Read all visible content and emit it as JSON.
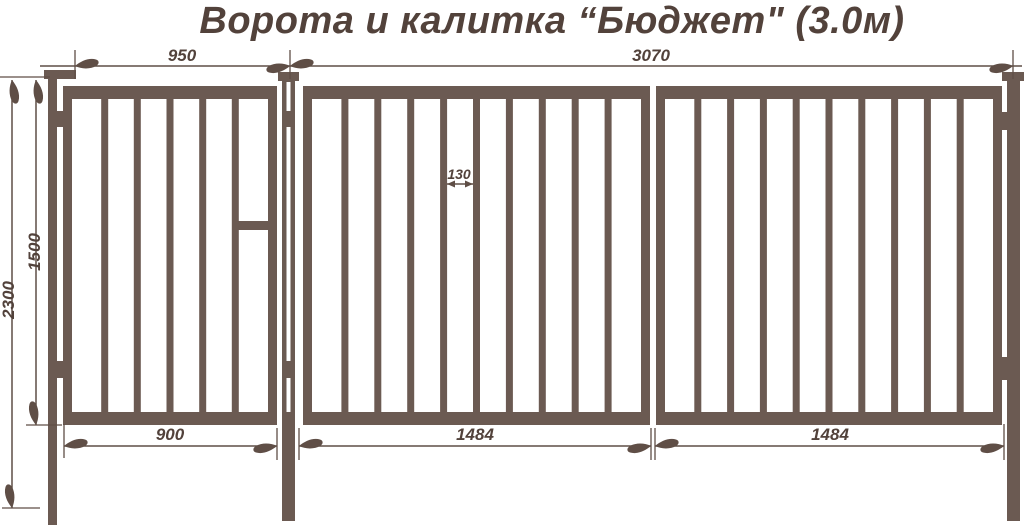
{
  "title": "Ворота и калитка “Бюджет\" (3.0м)",
  "colors": {
    "structure": "#6b5a52",
    "dim_line": "#5f4e46",
    "text": "#52423b",
    "background": "#ffffff"
  },
  "product": {
    "wicket": {
      "name_ru": "калитка",
      "opening_width_mm": 950,
      "frame_width_mm": 900,
      "frame_height_mm": 1500,
      "post_height_mm": 2300,
      "bars_count": 5
    },
    "gate": {
      "name_ru": "ворота",
      "opening_width_mm": 3070,
      "leaf_widths_mm": [
        1484,
        1484
      ],
      "bar_gap_mm": 130,
      "bars_per_leaf": 9
    }
  },
  "dimensions": {
    "d950": "950",
    "d3070": "3070",
    "d2300": "2300",
    "d1500": "1500",
    "d130": "130",
    "d900": "900",
    "d1484a": "1484",
    "d1484b": "1484"
  },
  "geometry": {
    "canvas": {
      "w": 1024,
      "h": 531
    },
    "bar": {
      "w": 7,
      "y": 99,
      "h": 313
    },
    "solids": [
      {
        "name": "left-post",
        "x": 48,
        "y": 78,
        "w": 9,
        "h": 447
      },
      {
        "name": "left-post-cap",
        "x": 44,
        "y": 70,
        "w": 32,
        "h": 9
      },
      {
        "name": "middle-post",
        "x": 282,
        "y": 80,
        "w": 13,
        "h": 441
      },
      {
        "name": "middle-post-cap",
        "x": 278,
        "y": 72,
        "w": 21,
        "h": 9
      },
      {
        "name": "right-post",
        "x": 1007,
        "y": 80,
        "w": 13,
        "h": 441
      },
      {
        "name": "right-post-cap",
        "x": 1002,
        "y": 72,
        "w": 22,
        "h": 9
      },
      {
        "name": "wicket-left-stile",
        "x": 63,
        "y": 86,
        "w": 9,
        "h": 339
      },
      {
        "name": "wicket-right-stile",
        "x": 268,
        "y": 86,
        "w": 9,
        "h": 339
      },
      {
        "name": "wicket-top-rail",
        "x": 63,
        "y": 86,
        "w": 214,
        "h": 13
      },
      {
        "name": "wicket-bottom-rail",
        "x": 63,
        "y": 412,
        "w": 214,
        "h": 13
      },
      {
        "name": "wicket-lock-crossbar",
        "x": 238,
        "y": 221,
        "w": 30,
        "h": 9
      },
      {
        "name": "gate-leaf1-left-stile",
        "x": 303,
        "y": 86,
        "w": 9,
        "h": 339
      },
      {
        "name": "gate-leaf1-right-stile",
        "x": 641,
        "y": 86,
        "w": 9,
        "h": 339
      },
      {
        "name": "gate-leaf1-top-rail",
        "x": 303,
        "y": 86,
        "w": 347,
        "h": 13
      },
      {
        "name": "gate-leaf1-bottom-rail",
        "x": 303,
        "y": 412,
        "w": 347,
        "h": 13
      },
      {
        "name": "gate-leaf2-left-stile",
        "x": 656,
        "y": 86,
        "w": 9,
        "h": 339
      },
      {
        "name": "gate-leaf2-right-stile",
        "x": 993,
        "y": 86,
        "w": 9,
        "h": 339
      },
      {
        "name": "gate-leaf2-top-rail",
        "x": 656,
        "y": 86,
        "w": 346,
        "h": 13
      },
      {
        "name": "gate-leaf2-bottom-rail",
        "x": 656,
        "y": 412,
        "w": 346,
        "h": 13
      },
      {
        "name": "wicket-hinge-top",
        "x": 48,
        "y": 111,
        "w": 24,
        "h": 16
      },
      {
        "name": "wicket-hinge-bottom",
        "x": 48,
        "y": 361,
        "w": 24,
        "h": 17
      },
      {
        "name": "gate-hinge-top",
        "x": 993,
        "y": 112,
        "w": 27,
        "h": 18
      },
      {
        "name": "gate-hinge-bottom",
        "x": 993,
        "y": 357,
        "w": 27,
        "h": 23
      }
    ],
    "bars": [
      {
        "name": "wicket-bar",
        "xs": [
          101.2,
          133.8,
          166.5,
          199.2,
          231.8
        ]
      },
      {
        "name": "gate-leaf1-bar",
        "xs": [
          341.4,
          374.3,
          407.2,
          440.1,
          473.0,
          505.9,
          538.8,
          571.7,
          604.6
        ]
      },
      {
        "name": "gate-leaf2-bar",
        "xs": [
          694.3,
          727.1,
          759.9,
          792.7,
          825.5,
          858.3,
          891.1,
          923.9,
          956.7
        ]
      }
    ],
    "white_overlays": [
      {
        "name": "middle-post-slit-top",
        "x": 286.5,
        "y": 82,
        "w": 4,
        "h": 29
      },
      {
        "name": "middle-post-slit-middle",
        "x": 286.5,
        "y": 127,
        "w": 4,
        "h": 234
      },
      {
        "name": "middle-post-slit-bottom",
        "x": 286.5,
        "y": 378,
        "w": 4,
        "h": 34
      }
    ],
    "dim_lines": [
      {
        "name": "dim-line-top",
        "x1": 40,
        "y1": 66,
        "x2": 1022,
        "y2": 66
      },
      {
        "name": "dim-line-left-outer",
        "x1": 12,
        "y1": 80,
        "x2": 12,
        "y2": 508
      },
      {
        "name": "dim-line-left-inner",
        "x1": 36,
        "y1": 80,
        "x2": 36,
        "y2": 425
      },
      {
        "name": "dim-line-bottom-wicket",
        "x1": 64,
        "y1": 446,
        "x2": 277,
        "y2": 446
      },
      {
        "name": "dim-line-bottom-leaf1",
        "x1": 299,
        "y1": 446,
        "x2": 651,
        "y2": 446
      },
      {
        "name": "dim-line-bottom-leaf2",
        "x1": 655,
        "y1": 446,
        "x2": 1004,
        "y2": 446
      },
      {
        "name": "dim-line-bar-gap",
        "x1": 447,
        "y1": 184,
        "x2": 473,
        "y2": 184
      }
    ],
    "ticks": [
      {
        "x1": 75,
        "y1": 50,
        "x2": 75,
        "y2": 79
      },
      {
        "x1": 290,
        "y1": 50,
        "x2": 290,
        "y2": 79
      },
      {
        "x1": 1013,
        "y1": 50,
        "x2": 1013,
        "y2": 79
      },
      {
        "x1": 0,
        "y1": 77,
        "x2": 50,
        "y2": 77
      },
      {
        "x1": 26,
        "y1": 425,
        "x2": 62,
        "y2": 425
      },
      {
        "x1": 2,
        "y1": 508,
        "x2": 40,
        "y2": 508
      },
      {
        "x1": 64,
        "y1": 424,
        "x2": 64,
        "y2": 458
      },
      {
        "x1": 277,
        "y1": 428,
        "x2": 277,
        "y2": 460
      },
      {
        "x1": 299,
        "y1": 428,
        "x2": 299,
        "y2": 460
      },
      {
        "x1": 651,
        "y1": 428,
        "x2": 651,
        "y2": 460
      },
      {
        "x1": 655,
        "y1": 428,
        "x2": 655,
        "y2": 460
      },
      {
        "x1": 1004,
        "y1": 424,
        "x2": 1004,
        "y2": 460
      }
    ],
    "arrows": [
      {
        "x": 75,
        "y": 66,
        "dir": "left"
      },
      {
        "x": 290,
        "y": 66,
        "dir": "right"
      },
      {
        "x": 290,
        "y": 66,
        "dir": "left"
      },
      {
        "x": 1013,
        "y": 66,
        "dir": "right"
      },
      {
        "x": 12,
        "y": 80,
        "dir": "up"
      },
      {
        "x": 12,
        "y": 508,
        "dir": "down"
      },
      {
        "x": 36,
        "y": 80,
        "dir": "up"
      },
      {
        "x": 36,
        "y": 425,
        "dir": "down"
      },
      {
        "x": 64,
        "y": 446,
        "dir": "left"
      },
      {
        "x": 277,
        "y": 446,
        "dir": "right"
      },
      {
        "x": 299,
        "y": 446,
        "dir": "left"
      },
      {
        "x": 651,
        "y": 446,
        "dir": "right"
      },
      {
        "x": 655,
        "y": 446,
        "dir": "left"
      },
      {
        "x": 1004,
        "y": 446,
        "dir": "right"
      }
    ],
    "tri_arrows": [
      {
        "x": 447,
        "y": 184,
        "dir": "left"
      },
      {
        "x": 473,
        "y": 184,
        "dir": "right"
      }
    ],
    "labels": [
      {
        "bind": "dimensions.d950",
        "x": 182,
        "y": 61,
        "size": 17
      },
      {
        "bind": "dimensions.d3070",
        "x": 651,
        "y": 61,
        "size": 17
      },
      {
        "bind": "dimensions.d2300",
        "x": 14,
        "y": 300,
        "size": 17,
        "rotate": -90
      },
      {
        "bind": "dimensions.d1500",
        "x": 40,
        "y": 252,
        "size": 17,
        "rotate": -90
      },
      {
        "bind": "dimensions.d130",
        "x": 459,
        "y": 179,
        "size": 14
      },
      {
        "bind": "dimensions.d900",
        "x": 170,
        "y": 440,
        "size": 17
      },
      {
        "bind": "dimensions.d1484a",
        "x": 475,
        "y": 440,
        "size": 17
      },
      {
        "bind": "dimensions.d1484b",
        "x": 830,
        "y": 440,
        "size": 17
      }
    ]
  }
}
